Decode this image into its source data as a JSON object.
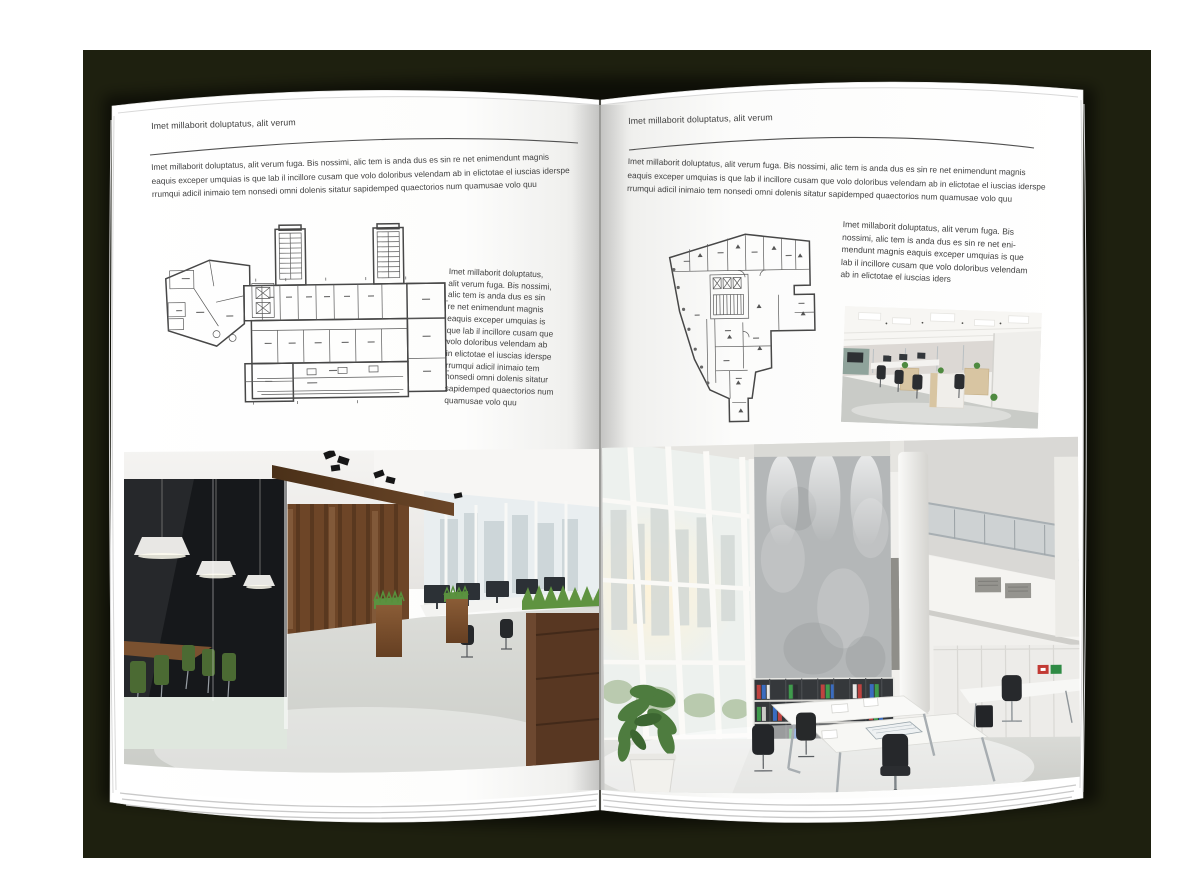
{
  "colors": {
    "backdrop": "#1e200f",
    "page_white": "#ffffff",
    "body_text": "#3d3d3d",
    "rule_line": "#515151",
    "plan_line": "#474747",
    "wood_wall": "#6d4527",
    "grass_green": "#5b9140",
    "binder_red": "#bf4340",
    "binder_green": "#3f9b4c",
    "binder_blue": "#3a6cc0"
  },
  "left_page": {
    "header": "Imet millaborit doluptatus, alit verum",
    "intro": "Imet millaborit doluptatus, alit verum fuga. Bis nossimi, alic tem is anda dus es sin re net enimendunt magnis\neaquis exceper umquias is que lab il incillore cusam que volo doloribus velendam ab in elictotae el iuscias iderspe\nrrumqui adicil inimaio tem nonsedi omni dolenis sitatur sapidemped quaectorios num quamusae volo quu",
    "side_text": "Imet millaborit doluptatus,\nalit verum fuga. Bis nossimi,\nalic tem is anda dus es sin\nre net enimendunt magnis\neaquis exceper umquias is\nque lab il incillore cusam que\nvolo doloribus velendam ab\nin elictotae el iuscias iderspe\nrrumqui adicil inimaio tem\nnonsedi omni dolenis sitatur\nsapidemped quaectorios num\nquamusae volo quu"
  },
  "right_page": {
    "header": "Imet millaborit doluptatus, alit verum",
    "intro": "Imet millaborit doluptatus, alit verum fuga. Bis nossimi, alic tem is anda dus es sin re net enimendunt magnis\neaquis exceper umquias is que lab il incillore cusam que volo doloribus velendam ab in elictotae el iuscias iderspe\nrrumqui adicil inimaio tem nonsedi omni dolenis sitatur sapidemped quaectorios num quamusae volo quu",
    "side_text": "Imet millaborit doluptatus, alit verum fuga. Bis\nnossimi, alic tem is anda dus es sin re net eni-\nmendunt magnis eaquis exceper umquias is que\nlab il incillore cusam que volo doloribus velendam\nab in elictotae el iuscias iders"
  }
}
